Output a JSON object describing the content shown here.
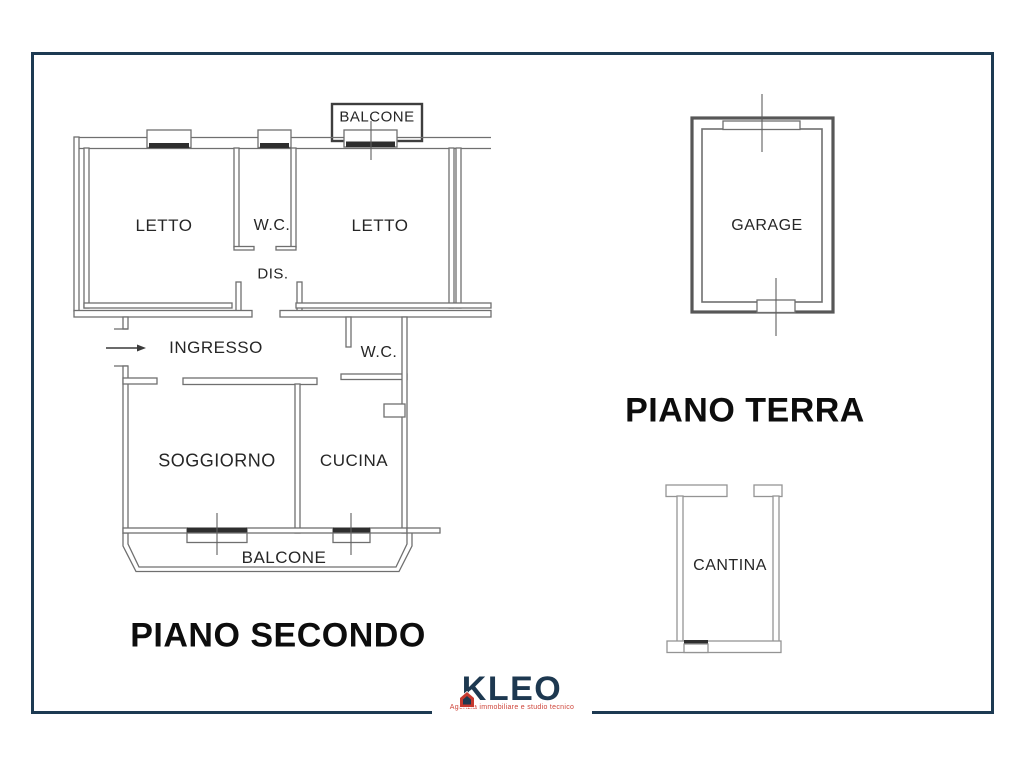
{
  "page": {
    "background": "#ffffff",
    "frame_color": "#1d3a52"
  },
  "floors": {
    "piano_secondo": {
      "title": "PIANO SECONDO",
      "labels": {
        "balcone_top": "BALCONE",
        "letto_left": "LETTO",
        "wc_top": "W.C.",
        "letto_right": "LETTO",
        "dis": "DIS.",
        "ingresso": "INGRESSO",
        "wc_mid": "W.C.",
        "soggiorno": "SOGGIORNO",
        "cucina": "CUCINA",
        "balcone_bottom": "BALCONE"
      }
    },
    "piano_terra": {
      "title": "PIANO TERRA",
      "labels": {
        "garage": "GARAGE",
        "cantina": "CANTINA"
      }
    }
  },
  "logo": {
    "name": "KLEO",
    "tagline": "Agenzia immobiliare e studio tecnico",
    "navy": "#1d3850",
    "red": "#c5392f"
  }
}
